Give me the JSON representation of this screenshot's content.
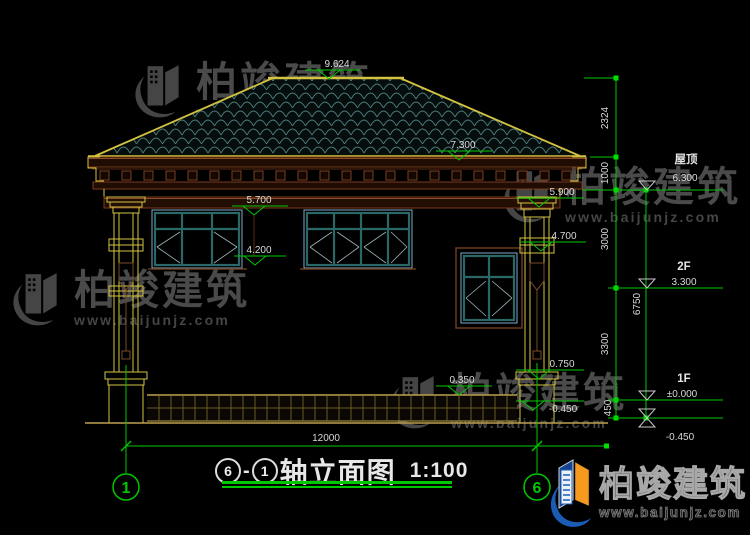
{
  "watermark": {
    "brand": "柏竣建筑",
    "url": "www.baijunjz.com"
  },
  "logo": {
    "brand": "柏竣建筑",
    "url": "www.baijunjz.com"
  },
  "title": {
    "bubble_left": "6",
    "dash": "-",
    "bubble_right": "1",
    "text": "轴立面图",
    "scale": "1:100"
  },
  "axes": {
    "left": "1",
    "right": "6"
  },
  "dims": {
    "width": "12000",
    "chain": {
      "c1": "2324",
      "c2": "1000",
      "c3": "3000",
      "c4": "3300",
      "c5": "450"
    },
    "overall": "6750"
  },
  "levels": {
    "roof_label": "屋顶",
    "roof": "6.300",
    "f2_label": "2F",
    "f2": "3.300",
    "f1_label": "1F",
    "f1": "±0.000",
    "ground": "-0.450"
  },
  "spots": {
    "ridge": "9.624",
    "eave": "7.300",
    "win_top": "5.700",
    "win_sill": "4.200",
    "porch": "5.900",
    "capital": "4.700",
    "rail": "0.750",
    "plinth": "0.350",
    "ground": "-0.450"
  },
  "colors": {
    "background": "#000000",
    "axis_green": "#00c800",
    "wall_yellow": "#d4c340",
    "cornice_brown": "#8a4a24",
    "tile_teal": "#4d7b7b",
    "window_blue": "#7fa8c8",
    "window_teal": "#2a6868",
    "plinth_tan": "#bd9f4e",
    "dim_text": "#d8d8d8",
    "watermark_gray": "#4a4a4a",
    "logo_blue": "#1a5cb5",
    "logo_orange": "#f59a1e"
  }
}
